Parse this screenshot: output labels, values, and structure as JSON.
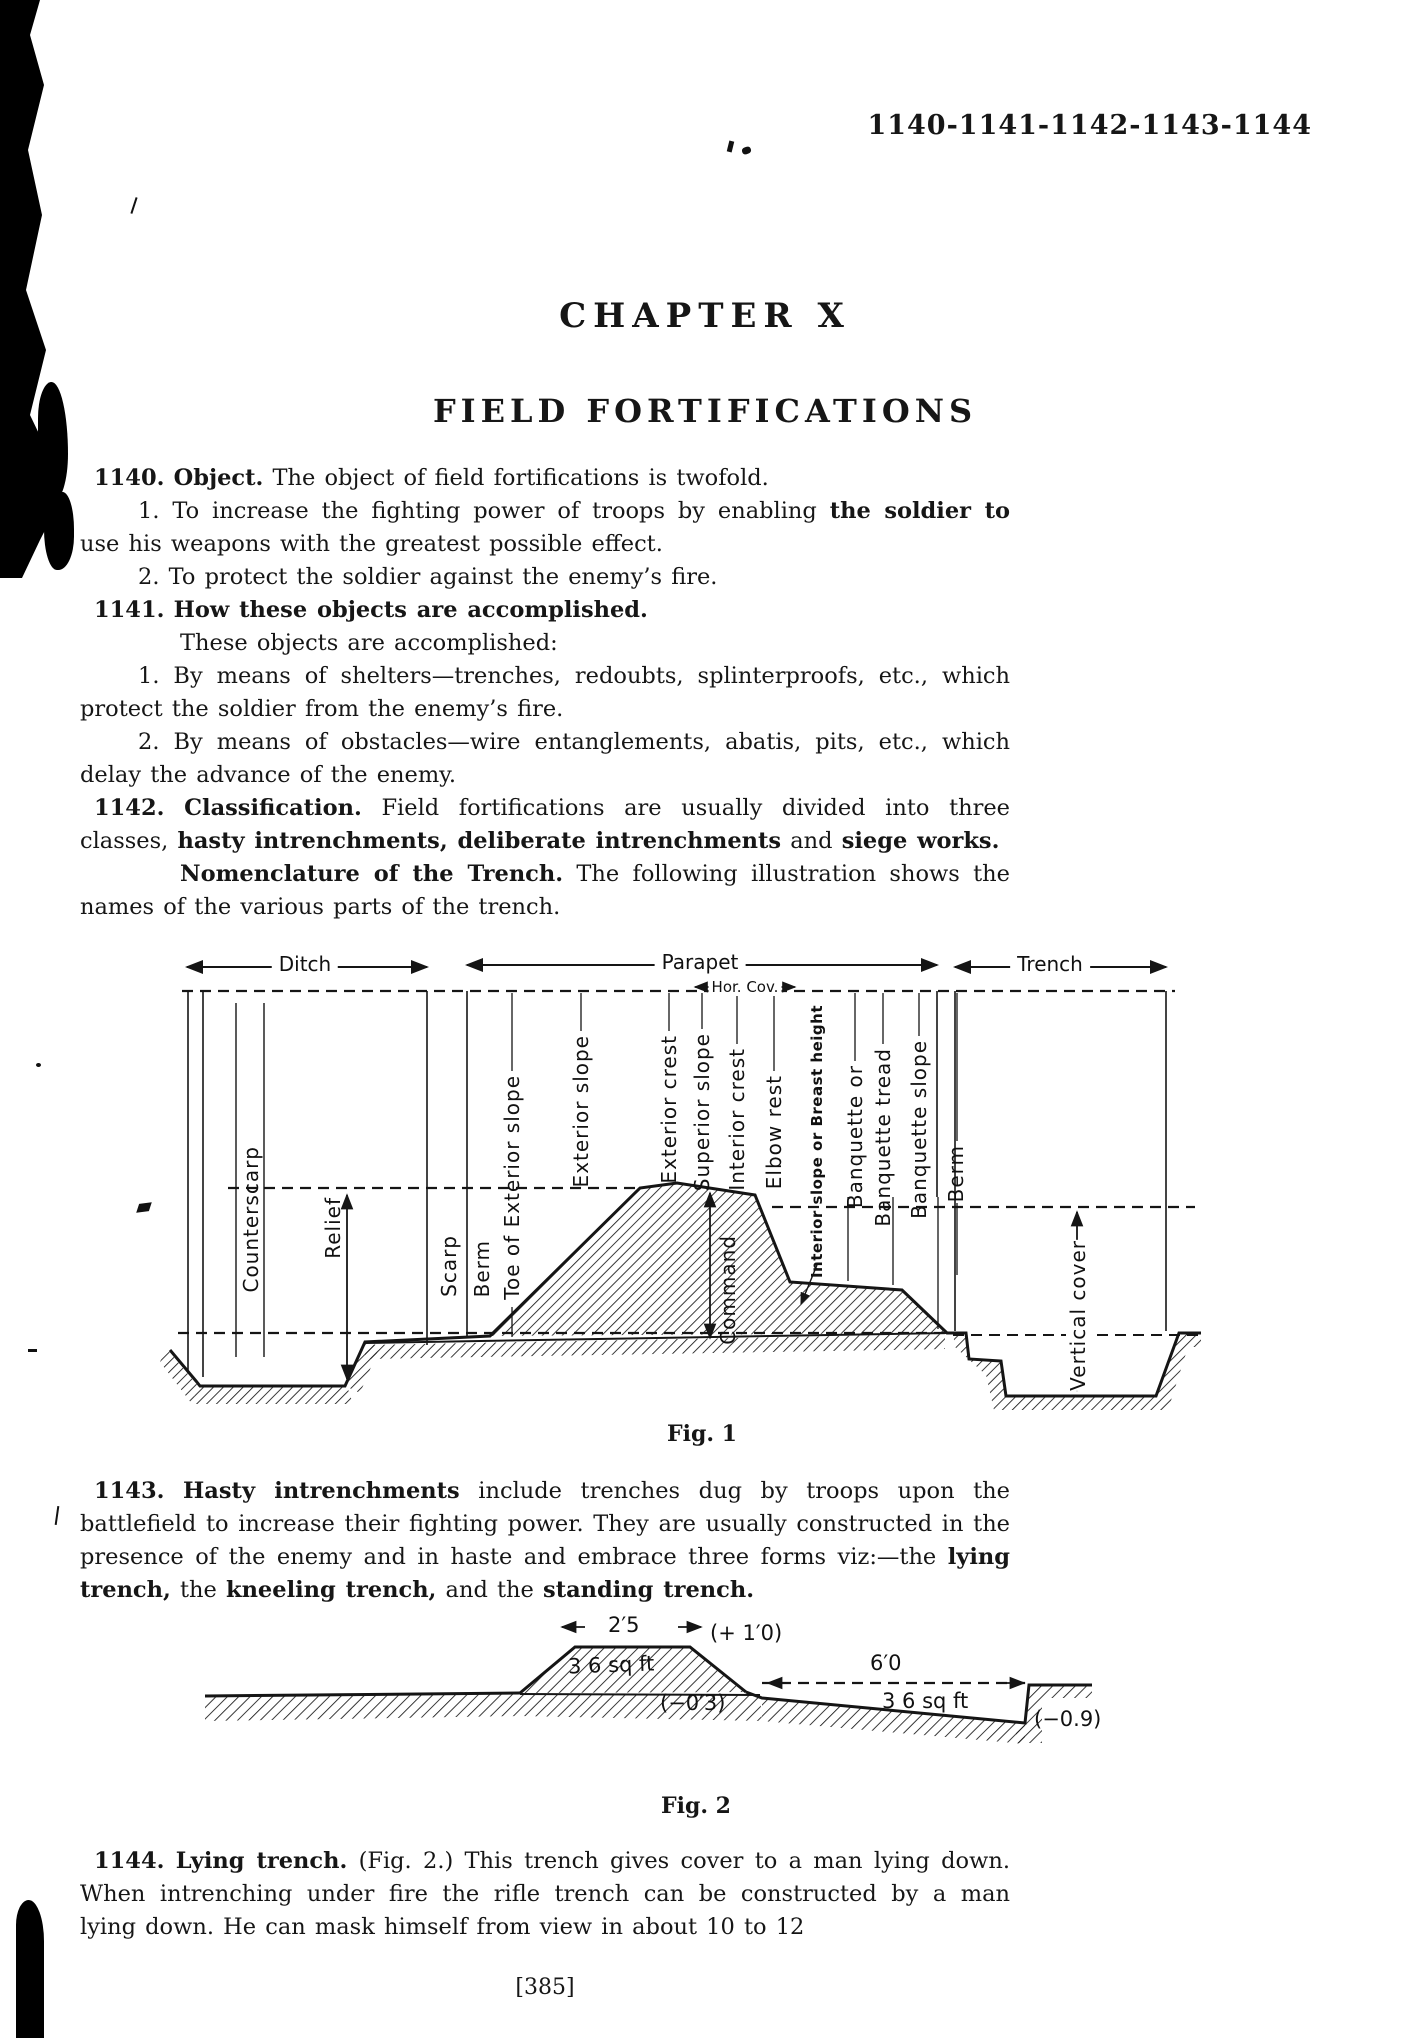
{
  "page": {
    "header_ref": "1140-1141-1142-1143-1144",
    "chapter_title": "CHAPTER X",
    "section_title": "FIELD FORTIFICATIONS",
    "page_number": "[385]"
  },
  "body": {
    "paragraphs": [
      {
        "segments": [
          {
            "t": "1140.",
            "b": 1
          },
          {
            "t": "  "
          },
          {
            "t": "Object.",
            "b": 1
          },
          {
            "t": "  The object of field fortifications is twofold."
          }
        ]
      },
      {
        "segments": [
          {
            "t": "1.  To increase the fighting power of troops by enabling "
          },
          {
            "t": "the soldier to",
            "b": 1
          },
          {
            "t": " use his weapons with the greatest possible effect."
          }
        ]
      },
      {
        "segments": [
          {
            "t": "2.  To protect the soldier against the enemy’s fire."
          }
        ]
      },
      {
        "segments": [
          {
            "t": "1141.",
            "b": 1
          },
          {
            "t": "  "
          },
          {
            "t": "How these objects are accomplished.",
            "b": 1
          }
        ]
      },
      {
        "segments": [
          {
            "t": "These objects are accomplished:"
          }
        ]
      },
      {
        "segments": [
          {
            "t": "1.  By means of shelters—trenches, redoubts, splinterproofs, etc., which protect the soldier from the enemy’s fire."
          }
        ]
      },
      {
        "segments": [
          {
            "t": "2.  By means of obstacles—wire entanglements, abatis, pits, etc., which delay the advance of the enemy."
          }
        ]
      },
      {
        "segments": [
          {
            "t": "1142.",
            "b": 1
          },
          {
            "t": "  "
          },
          {
            "t": "Classification.",
            "b": 1
          },
          {
            "t": "  Field fortifications are usually divided into three classes, "
          },
          {
            "t": "hasty intrenchments, deliberate intrenchments",
            "b": 1
          },
          {
            "t": " and "
          },
          {
            "t": "siege works.",
            "b": 1
          }
        ]
      },
      {
        "segments": [
          {
            "t": "Nomenclature of the Trench.",
            "b": 1
          },
          {
            "t": "  The following illustration shows the names of the various parts of the trench."
          }
        ]
      },
      {
        "segments": [
          {
            "t": "1143.",
            "b": 1
          },
          {
            "t": "  "
          },
          {
            "t": "Hasty intrenchments",
            "b": 1
          },
          {
            "t": " include trenches dug by troops upon the battlefield to increase their fighting power.  They are usually constructed in the presence of the enemy and in haste and embrace three forms viz:—the "
          },
          {
            "t": "lying trench,",
            "b": 1
          },
          {
            "t": " the "
          },
          {
            "t": "kneeling trench,",
            "b": 1
          },
          {
            "t": " and the "
          },
          {
            "t": "standing trench.",
            "b": 1
          }
        ]
      },
      {
        "segments": [
          {
            "t": "1144.",
            "b": 1
          },
          {
            "t": "  "
          },
          {
            "t": "Lying trench.",
            "b": 1
          },
          {
            "t": "  (Fig. 2.)  This trench gives cover to a man lying down.  When intrenching under fire the rifle trench can be constructed by a man lying down.  He can mask himself from view in about 10 to 12"
          }
        ]
      }
    ]
  },
  "fig1": {
    "caption": "Fig. 1",
    "dim_labels": {
      "ditch": "Ditch",
      "parapet": "Parapet",
      "hor_cov": "Hor. Cov.",
      "trench": "Trench"
    },
    "part_labels": {
      "counterscarp": "Counterscarp",
      "relief": "Relief",
      "scarp": "Scarp",
      "berm_left": "Berm",
      "toe_exterior_slope": "Toe of Exterior slope",
      "exterior_slope": "Exterior slope",
      "exterior_crest": "Exterior crest",
      "superior_slope": "Superior slope",
      "interior_crest": "Interior crest",
      "elbow_rest": "Elbow rest",
      "command": "Command",
      "interior_slope": "Interior slope or Breast height",
      "banquette_or": "Banquette or",
      "banquette_tread": "Banquette tread",
      "banquette_slope": "Banquette slope",
      "berm_right": "Berm",
      "vertical_cover": "Vertical cover"
    }
  },
  "fig2": {
    "caption": "Fig. 2",
    "labels": {
      "top_width": "2′5",
      "top_height": "(+ 1′0)",
      "parapet_area": "3 6 sq ft",
      "scrape_depth": "(−0′3)",
      "trench_width": "6′0",
      "trench_area": "3 6 sq ft",
      "trench_depth": "(−0.9)"
    }
  }
}
